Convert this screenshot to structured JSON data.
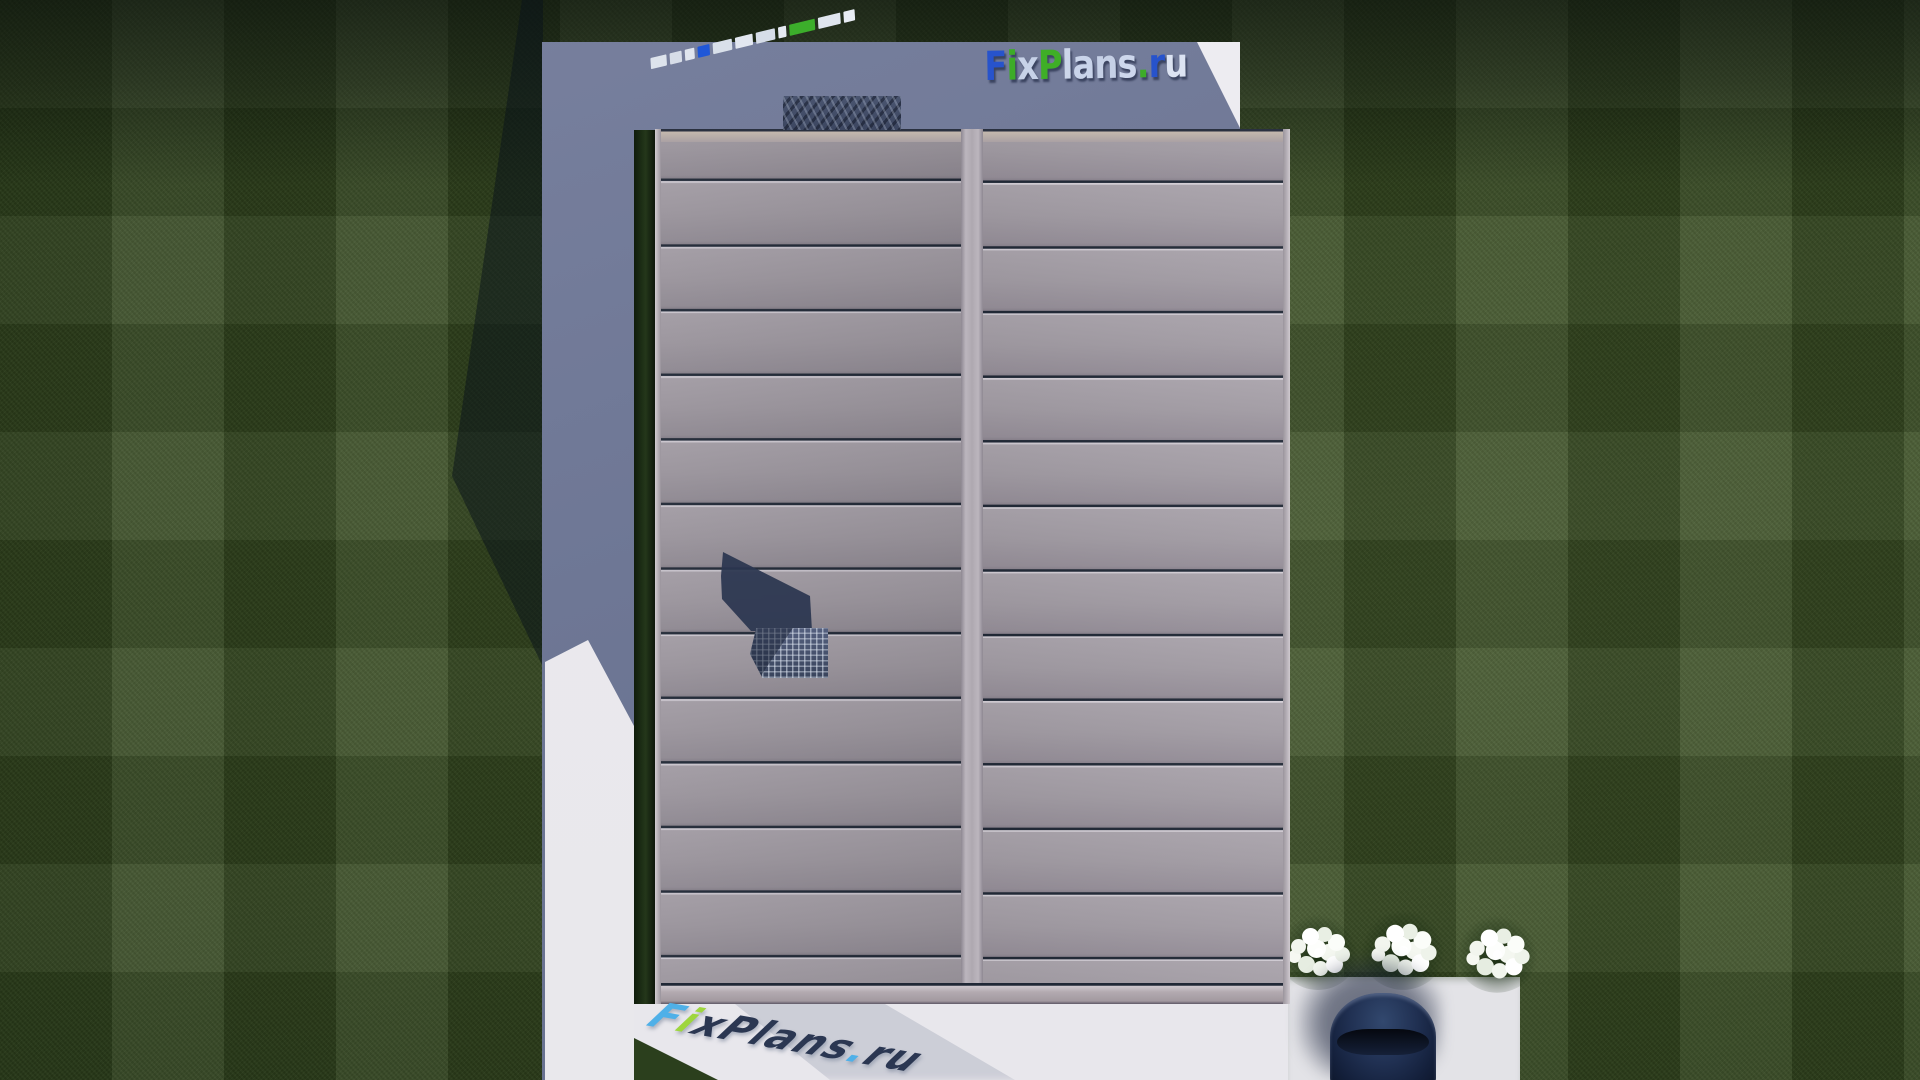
{
  "scene": {
    "description": "Top-down aerial 3D render of a house: dual-slope standing-seam roof, concrete pad in shadow, lawn, walkways, flower bushes, parked car",
    "view": "top-down"
  },
  "branding": {
    "main_logo": {
      "text": "FixPlans.ru",
      "letters": [
        {
          "ch": "F",
          "color": "#2753cc"
        },
        {
          "ch": "i",
          "color": "#3dac28"
        },
        {
          "ch": "x",
          "color": "#c7d2e8"
        },
        {
          "ch": "P",
          "color": "#3fae27"
        },
        {
          "ch": "l",
          "color": "#ccd6ea"
        },
        {
          "ch": "a",
          "color": "#c9d4ea"
        },
        {
          "ch": "n",
          "color": "#c5d0e6"
        },
        {
          "ch": "s",
          "color": "#cdd7ec"
        },
        {
          "ch": ".",
          "color": "#3dac28"
        },
        {
          "ch": "r",
          "color": "#2753cc"
        },
        {
          "ch": "u",
          "color": "#dce3f2"
        }
      ]
    },
    "ground_watermark": {
      "text": "FixPlans.ru",
      "letters": [
        {
          "ch": "F",
          "color": "#4fb0e8"
        },
        {
          "ch": "i",
          "color": "#9ed63e"
        },
        {
          "ch": "x",
          "color": "#2b3752"
        },
        {
          "ch": "P",
          "color": "#2b3752"
        },
        {
          "ch": "l",
          "color": "#2b3752"
        },
        {
          "ch": "a",
          "color": "#2b3752"
        },
        {
          "ch": "n",
          "color": "#2b3752"
        },
        {
          "ch": "s",
          "color": "#2b3752"
        },
        {
          "ch": ".",
          "color": "#4fb0e8"
        },
        {
          "ch": "r",
          "color": "#2b3752"
        },
        {
          "ch": "u",
          "color": "#2b3752"
        }
      ]
    },
    "mirror_strip_blocks": [
      {
        "width": 20,
        "color": "#dde3ec"
      },
      {
        "width": 15,
        "color": "#d7dde8"
      },
      {
        "width": 12,
        "color": "#e0e5ee"
      },
      {
        "width": 15,
        "color": "#1f57d8"
      },
      {
        "width": 24,
        "color": "#d9e0ea"
      },
      {
        "width": 22,
        "color": "#e2e7f0"
      },
      {
        "width": 24,
        "color": "#d6dde8"
      },
      {
        "width": 10,
        "color": "#e6eaf2"
      },
      {
        "width": 32,
        "color": "#3cae2b"
      },
      {
        "width": 28,
        "color": "#dfe5ee"
      },
      {
        "width": 14,
        "color": "#e8ecf4"
      }
    ]
  },
  "roof": {
    "slopes": 2,
    "seams_per_slope": 13,
    "ridge_position": "center-vertical",
    "color_left": "#9a949c",
    "color_right": "#a29ca4"
  },
  "yard": {
    "flower_bush_count": 3,
    "car_color": "#14213b",
    "grass_color": "#394d22",
    "pad_shadow_color": "#6e7795",
    "pavement_color": "#e8e7ec"
  }
}
